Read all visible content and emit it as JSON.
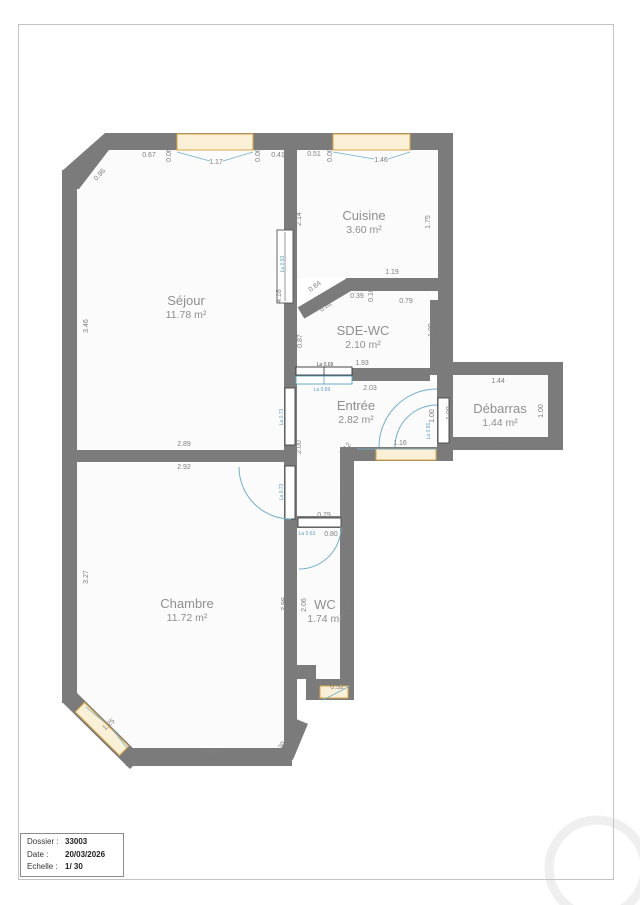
{
  "title_block": {
    "dossier_label": "Dossier :",
    "dossier_value": "33003",
    "date_label": "Date :",
    "date_value": "20/03/2026",
    "echelle_label": "Echelle :",
    "echelle_value": "1/ 30"
  },
  "colors": {
    "wall": "#7b7b7b",
    "room_fill": "#fbfbfb",
    "dim_gray": "#7f7f7f",
    "dim_dark": "#4d4d4d",
    "blue": "#5b9fc0",
    "window_border": "#dca844",
    "window_fill": "#faf0d7",
    "watermark": "#efefef"
  },
  "rooms": [
    {
      "name": "Séjour",
      "area": "11.78 m²",
      "x": 186,
      "y": 305
    },
    {
      "name": "Cuisine",
      "area": "3.60 m²",
      "x": 364,
      "y": 220
    },
    {
      "name": "SDE-WC",
      "area": "2.10 m²",
      "x": 363,
      "y": 335
    },
    {
      "name": "Entrée",
      "area": "2.82 m²",
      "x": 356,
      "y": 410
    },
    {
      "name": "Débarras",
      "area": "1.44 m²",
      "x": 500,
      "y": 413
    },
    {
      "name": "Chambre",
      "area": "11.72 m²",
      "x": 187,
      "y": 608
    },
    {
      "name": "WC",
      "area": "1.74 m²",
      "x": 325,
      "y": 609
    }
  ],
  "dimensions": [
    {
      "t": "0.67",
      "x": 149,
      "y": 157
    },
    {
      "t": "0.06",
      "x": 171,
      "y": 155,
      "r": -90
    },
    {
      "t": "1.17",
      "x": 216,
      "y": 164
    },
    {
      "t": "0.06",
      "x": 260,
      "y": 155,
      "r": -90
    },
    {
      "t": "0.41",
      "x": 278,
      "y": 157
    },
    {
      "t": "0.96",
      "x": 101,
      "y": 176,
      "r": -47
    },
    {
      "t": "0.51",
      "x": 314,
      "y": 156
    },
    {
      "t": "0.06",
      "x": 332,
      "y": 155,
      "r": -90
    },
    {
      "t": "1.46",
      "x": 381,
      "y": 162
    },
    {
      "t": "2.14",
      "x": 301,
      "y": 219,
      "r": -90
    },
    {
      "t": "1.75",
      "x": 430,
      "y": 222,
      "r": -90
    },
    {
      "t": "1.19",
      "x": 392,
      "y": 274
    },
    {
      "t": "0.84",
      "x": 316,
      "y": 288,
      "r": -37
    },
    {
      "t": "0.39",
      "x": 357,
      "y": 298
    },
    {
      "t": "0.10",
      "x": 373,
      "y": 295,
      "r": -90
    },
    {
      "t": "0.79",
      "x": 406,
      "y": 303
    },
    {
      "t": "0.82",
      "x": 327,
      "y": 308,
      "r": -37
    },
    {
      "t": "0.87",
      "x": 302,
      "y": 341,
      "r": -90
    },
    {
      "t": "1.09",
      "x": 433,
      "y": 330,
      "r": -90
    },
    {
      "t": "1.93",
      "x": 362,
      "y": 365
    },
    {
      "t": "2.03",
      "x": 370,
      "y": 390
    },
    {
      "t": "4.18",
      "x": 281,
      "y": 296,
      "r": -90
    },
    {
      "t": "3.46",
      "x": 88,
      "y": 326,
      "r": -90
    },
    {
      "t": "2.89",
      "x": 184,
      "y": 446
    },
    {
      "t": "2.92",
      "x": 184,
      "y": 469
    },
    {
      "t": "2.00",
      "x": 301,
      "y": 447,
      "r": -90
    },
    {
      "t": "0.12",
      "x": 347,
      "y": 450,
      "r": -52
    },
    {
      "t": "0.91",
      "x": 347,
      "y": 489,
      "r": -90
    },
    {
      "t": "1.16",
      "x": 400,
      "y": 445
    },
    {
      "t": "1.00",
      "x": 434,
      "y": 416,
      "r": -90
    },
    {
      "t": "1.00",
      "x": 451,
      "y": 413,
      "r": -90
    },
    {
      "t": "1.44",
      "x": 498,
      "y": 383
    },
    {
      "t": "1.00",
      "x": 543,
      "y": 411,
      "r": -90
    },
    {
      "t": "1.44",
      "x": 498,
      "y": 447
    },
    {
      "t": "0.79",
      "x": 324,
      "y": 517
    },
    {
      "t": "0.80",
      "x": 331,
      "y": 536
    },
    {
      "t": "3.27",
      "x": 88,
      "y": 577,
      "r": -90
    },
    {
      "t": "3.99",
      "x": 286,
      "y": 604,
      "r": -90
    },
    {
      "t": "2.06",
      "x": 306,
      "y": 605,
      "r": -90
    },
    {
      "t": "2.24",
      "x": 350,
      "y": 609,
      "r": -90
    },
    {
      "t": "0.28",
      "x": 306,
      "y": 671
    },
    {
      "t": "0.18",
      "x": 320,
      "y": 686,
      "r": -72
    },
    {
      "t": "0.52",
      "x": 337,
      "y": 689
    },
    {
      "t": "1.25",
      "x": 110,
      "y": 726,
      "r": -42
    },
    {
      "t": "1.92",
      "x": 211,
      "y": 755
    },
    {
      "t": "0.20",
      "x": 282,
      "y": 749,
      "r": -55
    },
    {
      "t": "La 0.69",
      "x": 325,
      "y": 366,
      "c": "d",
      "s": 5
    },
    {
      "t": "La 0.69",
      "x": 322,
      "y": 391,
      "c": "b",
      "s": 5
    },
    {
      "t": "La 0.93",
      "x": 284,
      "y": 264,
      "r": -90,
      "c": "b",
      "s": 5
    },
    {
      "t": "La 0.73",
      "x": 283,
      "y": 417,
      "r": -90,
      "c": "b",
      "s": 5
    },
    {
      "t": "La 0.73",
      "x": 283,
      "y": 492,
      "r": -90,
      "c": "b",
      "s": 5
    },
    {
      "t": "La 0.63",
      "x": 307,
      "y": 535,
      "c": "b",
      "s": 5
    },
    {
      "t": "La 0.91",
      "x": 430,
      "y": 431,
      "r": -90,
      "c": "b",
      "s": 5
    }
  ]
}
